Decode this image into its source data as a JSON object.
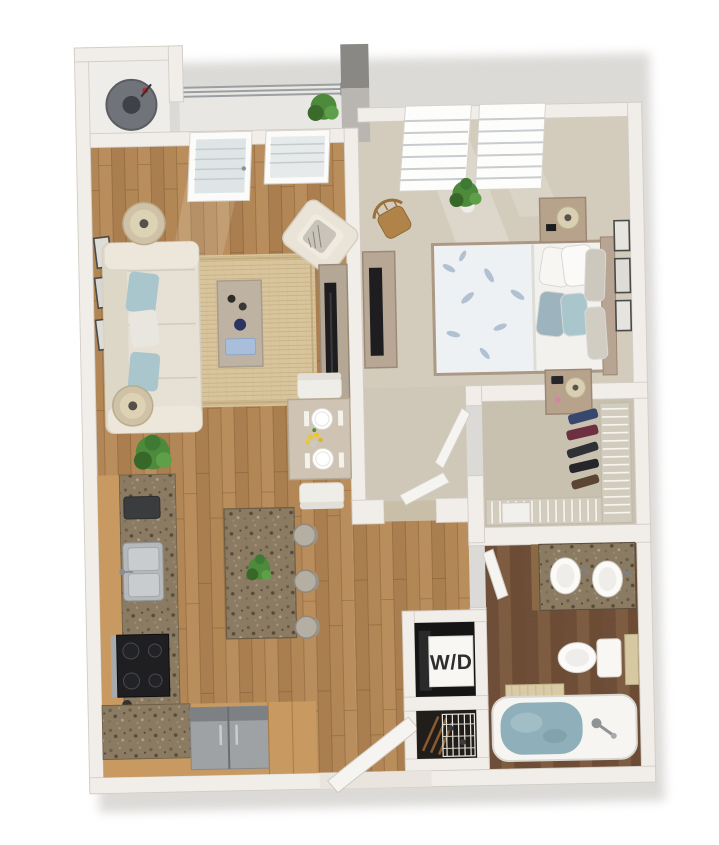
{
  "scene": {
    "type": "3d-floor-plan",
    "view": "top-down render",
    "background": "#ffffff"
  },
  "labels": {
    "washer_dryer": "W/D"
  },
  "palette": {
    "wall": "#f1eeea",
    "wall_edge": "#d3cdc5",
    "wood_floor": "#b28655",
    "wood_floor_dark": "#6e4e38",
    "carpet_bedroom": "#d3ccbc",
    "carpet_closet": "#c8c1b0",
    "granite": "#8b7b63",
    "cabinet_wood": "#c89a61",
    "sofa": "#e6e1d4",
    "accent_pillow": "#a9c6cc",
    "rug": "#d9c59d",
    "tub_water": "#8fb0ba",
    "appliance_dark": "#151515",
    "stainless": "#9fa2a5",
    "railing": "#9b9fa2",
    "plant": "#4e8a3c",
    "balcony_column": "#8a8884"
  },
  "rooms": [
    {
      "id": "balcony",
      "features": [
        "railing",
        "balcony-plant",
        "storage-nook",
        "round-grill"
      ]
    },
    {
      "id": "living-room",
      "features": [
        "sofa",
        "accent-pillows",
        "floor-lamp",
        "floor-lamp",
        "area-rug",
        "coffee-table",
        "decor-vase",
        "armchair",
        "tv-console",
        "tv",
        "wall-frames-x3",
        "floor-plant",
        "balcony-door",
        "window"
      ]
    },
    {
      "id": "dining-area",
      "features": [
        "dining-table",
        "dining-chair",
        "dining-chair",
        "place-setting",
        "place-setting",
        "yellow-flowers"
      ]
    },
    {
      "id": "kitchen",
      "features": [
        "l-shaped-counter",
        "granite-countertop",
        "double-sink",
        "range-cooktop",
        "countertop-appliance",
        "refrigerator",
        "tall-cabinet",
        "island",
        "island-plant",
        "bar-stool",
        "bar-stool",
        "bar-stool"
      ]
    },
    {
      "id": "bedroom",
      "features": [
        "bed",
        "floral-duvet",
        "pillows",
        "headboard",
        "nightstand",
        "nightstand",
        "table-lamp",
        "table-lamp",
        "media-dresser",
        "tv",
        "wood-chair",
        "potted-plant",
        "window",
        "window",
        "wall-frames-x3"
      ]
    },
    {
      "id": "walk-in-closet",
      "features": [
        "wire-shelving",
        "hanging-clothes",
        "drawer-unit",
        "closet-door"
      ]
    },
    {
      "id": "bathroom",
      "features": [
        "granite-vanity",
        "sink",
        "sink",
        "toilet",
        "towel-bar",
        "bath-mat",
        "bathtub",
        "tub-faucet",
        "bathroom-door"
      ]
    },
    {
      "id": "laundry-closet",
      "features": [
        "stacked-washer-dryer",
        "wd-label"
      ]
    },
    {
      "id": "storage-closet",
      "features": [
        "wire-shelf",
        "stored-items"
      ]
    },
    {
      "id": "entry",
      "features": [
        "front-door",
        "threshold",
        "hall-doorway"
      ]
    }
  ]
}
